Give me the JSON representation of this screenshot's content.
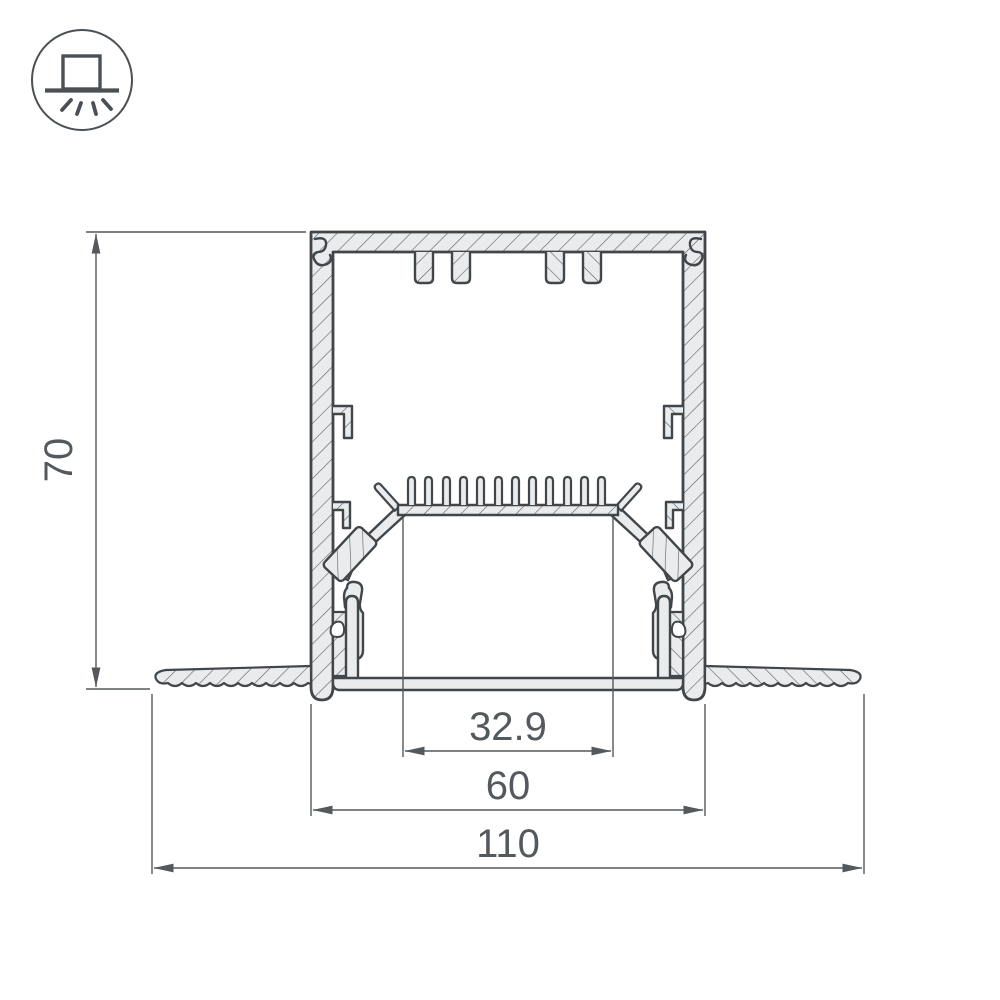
{
  "drawing": {
    "type": "technical-cross-section",
    "dimension_labels": {
      "height": "70",
      "window": "32.9",
      "body": "60",
      "overall": "110"
    },
    "colors": {
      "outline": "#41464b",
      "dimension": "#54595d",
      "section_fill": "#e9ebec",
      "hatch_line": "#5a5f63",
      "background": "#ffffff"
    }
  },
  "icon": {
    "name": "recessed-downlight-symbol"
  }
}
